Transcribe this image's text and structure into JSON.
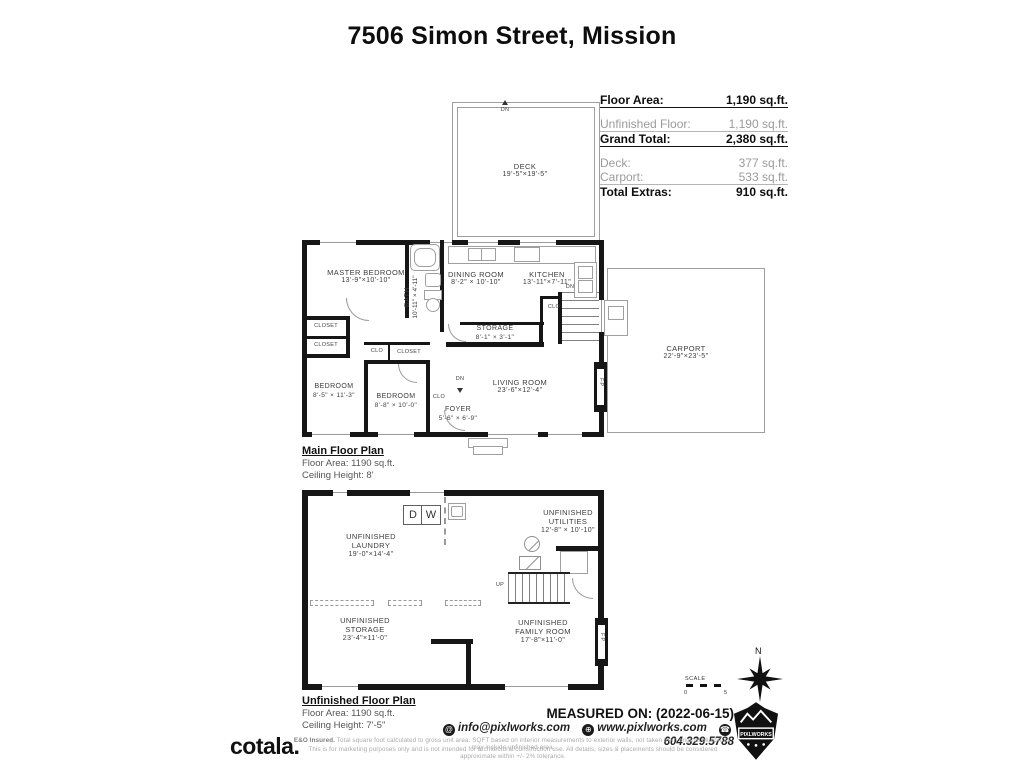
{
  "title": "7506 Simon Street, Mission",
  "area_table": {
    "floor_area": {
      "label": "Floor Area:",
      "value": "1,190 sq.ft."
    },
    "unfinished_floor": {
      "label": "Unfinished Floor:",
      "value": "1,190 sq.ft."
    },
    "grand_total": {
      "label": "Grand Total:",
      "value": "2,380 sq.ft."
    },
    "deck": {
      "label": "Deck:",
      "value": "377 sq.ft."
    },
    "carport": {
      "label": "Carport:",
      "value": "533 sq.ft."
    },
    "total_extras": {
      "label": "Total Extras:",
      "value": "910 sq.ft."
    }
  },
  "main_floor": {
    "deck": {
      "name": "DECK",
      "dims": "19'-5\"×19'-5\""
    },
    "master_bedroom": {
      "name": "MASTER BEDROOM",
      "dims": "13'-9\"×10'-10\""
    },
    "bath": {
      "name": "BATH",
      "dims": "10'-11\" × 4'-11\""
    },
    "dining_room": {
      "name": "DINING ROOM",
      "dims": "8'-2\" × 10'-10\""
    },
    "kitchen": {
      "name": "KITCHEN",
      "dims": "13'-11\"×7'-11\""
    },
    "storage": {
      "name": "STORAGE",
      "dims": "8'-1\" × 3'-1\""
    },
    "bedroom1": {
      "name": "BEDROOM",
      "dims": "8'-5\" × 11'-3\""
    },
    "bedroom2": {
      "name": "BEDROOM",
      "dims": "8'-8\" × 10'-0\""
    },
    "foyer": {
      "name": "FOYER",
      "dims": "5'-6\" × 6'-9\""
    },
    "living_room": {
      "name": "LIVING ROOM",
      "dims": "23'-6\"×12'-4\""
    },
    "carport": {
      "name": "CARPORT",
      "dims": "22'-9\"×23'-5\""
    },
    "caption": {
      "title": "Main Floor Plan",
      "area": "Floor Area: 1190 sq.ft.",
      "ceiling": "Ceiling Height: 8'"
    }
  },
  "lower_floor": {
    "laundry": {
      "line1": "UNFINISHED",
      "line2": "LAUNDRY",
      "dims": "19'-0\"×14'-4\""
    },
    "utilities": {
      "line1": "UNFINISHED",
      "line2": "UTILITIES",
      "dims": "12'-8\" × 10'-10\""
    },
    "storage": {
      "line1": "UNFINISHED",
      "line2": "STORAGE",
      "dims": "23'-4\"×11'-0\""
    },
    "family_room": {
      "line1": "UNFINISHED",
      "line2": "FAMILY ROOM",
      "dims": "17'-8\"×11'-0\""
    },
    "caption": {
      "title": "Unfinished Floor Plan",
      "area": "Floor Area: 1190 sq.ft.",
      "ceiling": "Ceiling Height: 7'-5\""
    }
  },
  "annotations": {
    "down": "DN",
    "up": "UP",
    "fireplace": "FP",
    "closet": "CLOSET",
    "closet_abbr": "CLO",
    "dryer": "D",
    "washer": "W"
  },
  "compass": {
    "north": "N",
    "scale_label": "SCALE",
    "scale_start": "0",
    "scale_end": "5"
  },
  "footer": {
    "measured_on": "MEASURED ON: (2022-06-15)",
    "email": "info@pixlworks.com",
    "website": "www.pixlworks.com",
    "phone": "604.329.5788",
    "brand": "cotala.",
    "badge": "PIXLWORKS",
    "disclaimer_prefix": "E&O Insured.",
    "disclaimer_line1": "Total square foot calculated to gross unit area. SQFT based on interior measurements to exterior walls, not taken from original blueprints, may include unfinished area.",
    "disclaimer_line2": "This is for marketing purposes only and is not intended for architectural/construction use.  All details, sizes & placements should be considered approximate within +/- 2% tolerance."
  },
  "colors": {
    "wall": "#161616",
    "light_line": "#9a9a9a",
    "muted": "#9b9b9b",
    "text": "#3d3d3d"
  }
}
